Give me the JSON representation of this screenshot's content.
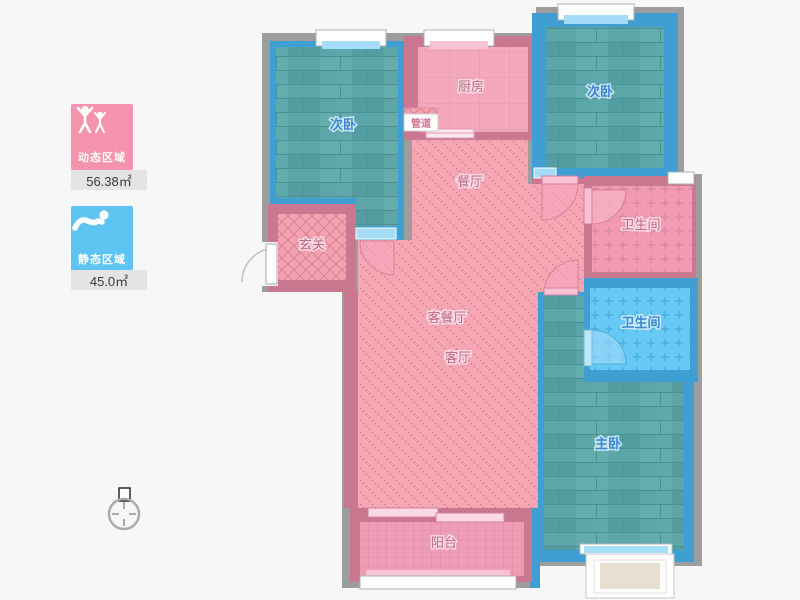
{
  "legend": {
    "dynamic_area": {
      "label": "动态区域",
      "value": "56.38㎡",
      "color": "#f592ad",
      "icon": "people-arms-up-icon"
    },
    "static_area": {
      "label": "静态区域",
      "value": "45.0㎡",
      "color": "#5ec5f2",
      "icon": "sleeping-person-icon"
    }
  },
  "rooms": {
    "bedroom_left": {
      "label": "次卧"
    },
    "bedroom_right": {
      "label": "次卧"
    },
    "kitchen": {
      "label": "厨房"
    },
    "pipe_duct": {
      "label": "管道"
    },
    "dining": {
      "label": "餐厅"
    },
    "foyer": {
      "label": "玄关"
    },
    "living_dining": {
      "label": "客餐厅"
    },
    "living": {
      "label": "客厅"
    },
    "bathroom_upper": {
      "label": "卫生间"
    },
    "bathroom_lower": {
      "label": "卫生间"
    },
    "master_bedroom": {
      "label": "主卧"
    },
    "balcony": {
      "label": "阳台"
    }
  },
  "colors": {
    "wall_gray": "#9d9d9d",
    "wall_pink": "#c9788f",
    "wall_blue": "#3f9fd2",
    "floor_wood_teal": "#5ca6aa",
    "floor_pink": "#f3a8bc",
    "bathroom_blue": "#66c8f4",
    "window_sill_blue": "#a5dcf7",
    "window_sill_pink": "#f7c3d4",
    "legend_value_bg": "#e4e4e4"
  }
}
